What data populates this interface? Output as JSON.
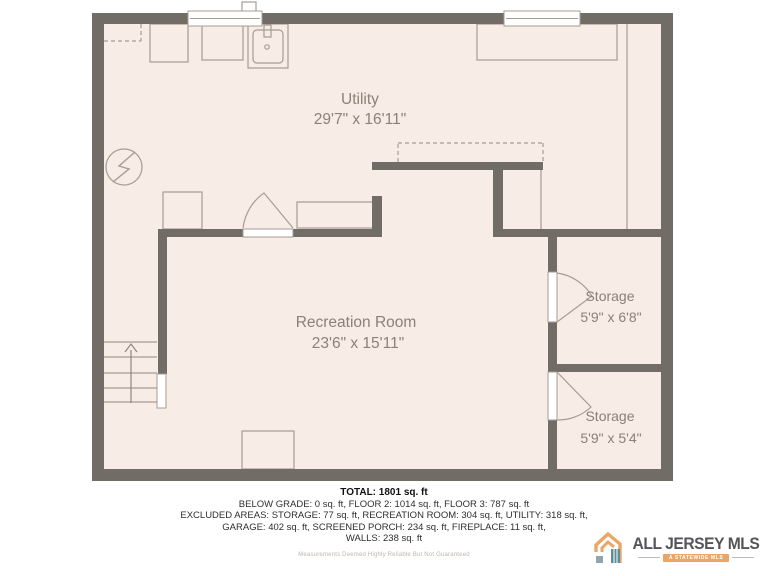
{
  "plan": {
    "type": "floor-plan",
    "rooms": {
      "utility": {
        "label": "Utility",
        "dims": "29'7\" x 16'11\""
      },
      "recreation": {
        "label": "Recreation Room",
        "dims": "23'6\" x 15'11\""
      },
      "storage_upper": {
        "label": "Storage",
        "dims": "5'9\" x 6'8\""
      },
      "storage_lower": {
        "label": "Storage",
        "dims": "5'9\" x 5'4\""
      }
    },
    "symbols": [
      "electrical-panel",
      "utility-sink",
      "washer",
      "dryer",
      "staircase-up-arrow",
      "door-swing",
      "window",
      "fireplace",
      "counter"
    ]
  },
  "summary": {
    "total": "TOTAL: 1801 sq. ft",
    "lines": [
      "BELOW GRADE: 0 sq. ft, FLOOR 2: 1014 sq. ft, FLOOR 3: 787 sq. ft",
      "EXCLUDED AREAS: STORAGE: 77 sq. ft, RECREATION ROOM: 304 sq. ft, UTILITY: 318 sq. ft,",
      "GARAGE: 402 sq. ft, SCREENED PORCH: 234 sq. ft, FIREPLACE: 11 sq. ft,",
      "WALLS: 238 sq. ft"
    ],
    "disclaimer": "Measurements Deemed Highly Reliable But Not Guaranteed"
  },
  "logo": {
    "name": "ALL JERSEY MLS",
    "tagline": "A STATEWIDE MLS"
  },
  "colors": {
    "wall": "#716C66",
    "floor": "#F8ECE6",
    "line": "#A59D94",
    "label": "#8B8177",
    "ink": "#2E2E2E",
    "orange": "#E9A666",
    "teal": "#5D8D99"
  }
}
